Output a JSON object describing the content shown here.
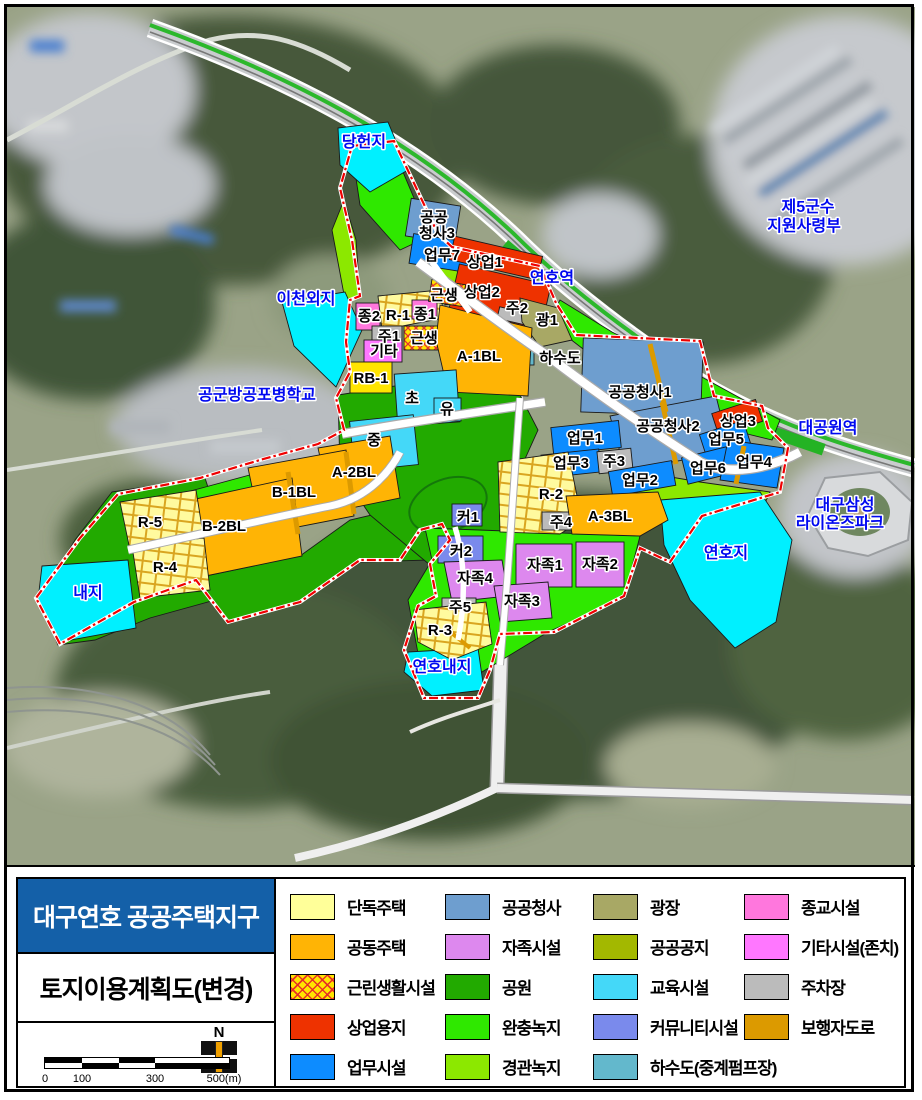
{
  "header": {
    "title": "대구연호 공공주택지구",
    "subtitle": "토지이용계획도(변경)"
  },
  "scale": {
    "north": "N",
    "ticks": [
      "0",
      "100",
      "300",
      "500(m)"
    ]
  },
  "colors": {
    "detached": "#FFFF99",
    "apartment": "#FFB405",
    "neighborhood_base": "#FFE400",
    "commercial": "#EE3200",
    "business": "#0D8CFF",
    "public_office": "#6E9ECF",
    "selfsufficiency": "#DD88EE",
    "park": "#22AA00",
    "buffer_green": "#2FE800",
    "landscape_green": "#8CE800",
    "plaza": "#A8A865",
    "public_space": "#A3B800",
    "education": "#44D8F8",
    "community": "#7A8AEC",
    "sewage": "#63B8CC",
    "religious": "#FF77DD",
    "other_retained": "#FF77FF",
    "parking": "#BBBBBB",
    "pedestrian": "#DC9A00",
    "water": "#00F0FF",
    "rb_block": "#FFE400",
    "title_bg": "#1460A8",
    "boundary": "#F00000",
    "rail_green": "#24B324"
  },
  "legend": {
    "columns": [
      [
        {
          "label": "단독주택"
        },
        {
          "label": "공동주택"
        },
        {
          "label": "근린생활시설"
        },
        {
          "label": "상업용지"
        },
        {
          "label": "업무시설"
        }
      ],
      [
        {
          "label": "공공청사"
        },
        {
          "label": "자족시설"
        },
        {
          "label": "공원"
        },
        {
          "label": "완충녹지"
        },
        {
          "label": "경관녹지"
        }
      ],
      [
        {
          "label": "광장"
        },
        {
          "label": "공공공지"
        },
        {
          "label": "교육시설"
        },
        {
          "label": "커뮤니티시설"
        },
        {
          "label": "하수도(중계펌프장)"
        }
      ],
      [
        {
          "label": "종교시설"
        },
        {
          "label": "기타시설(존치)"
        },
        {
          "label": "주차장"
        },
        {
          "label": "보행자도로"
        }
      ]
    ]
  },
  "map": {
    "labels": {
      "danghyeonji": "당헌지",
      "jegun1": "제5군수",
      "jegun2": "지원사령부",
      "icheonoeji": "이천외지",
      "yeonho_station": "연호역",
      "daegongwon_station": "대공원역",
      "airforce_school": "공군방공포병학교",
      "samsung1": "대구삼성",
      "samsung2": "라이온즈파크",
      "yeonhoji": "연호지",
      "naeji": "내지",
      "yeonhonaeji": "연호내지",
      "gcs3a": "공공",
      "gcs3b": "청사3",
      "eop7": "업무7",
      "sang1": "상업1",
      "sang2": "상업2",
      "ju2": "주2",
      "gwang1": "광1",
      "hasudo": "하수도",
      "geunsaeng_a": "근생",
      "jong2": "종2",
      "r1": "R-1",
      "jong1": "종1",
      "ju1": "주1",
      "geunsaeng_b": "근생",
      "gita": "기타",
      "rb1": "RB-1",
      "a1bl": "A-1BL",
      "cho": "초",
      "yu": "유",
      "jung": "중",
      "gcs1": "공공청사1",
      "gcs2": "공공청사2",
      "eop1": "업무1",
      "eop3": "업무3",
      "ju3": "주3",
      "eop2": "업무2",
      "sang3": "상업3",
      "eop5": "업무5",
      "eop6": "업무6",
      "eop4": "업무4",
      "a2bl": "A-2BL",
      "b1bl": "B-1BL",
      "b2bl": "B-2BL",
      "r5": "R-5",
      "r4": "R-4",
      "r2": "R-2",
      "ju4": "주4",
      "a3bl": "A-3BL",
      "keo1": "커1",
      "keo2": "커2",
      "jajok1": "자족1",
      "jajok2": "자족2",
      "jajok3": "자족3",
      "jajok4": "자족4",
      "ju5": "주5",
      "r3": "R-3"
    }
  }
}
